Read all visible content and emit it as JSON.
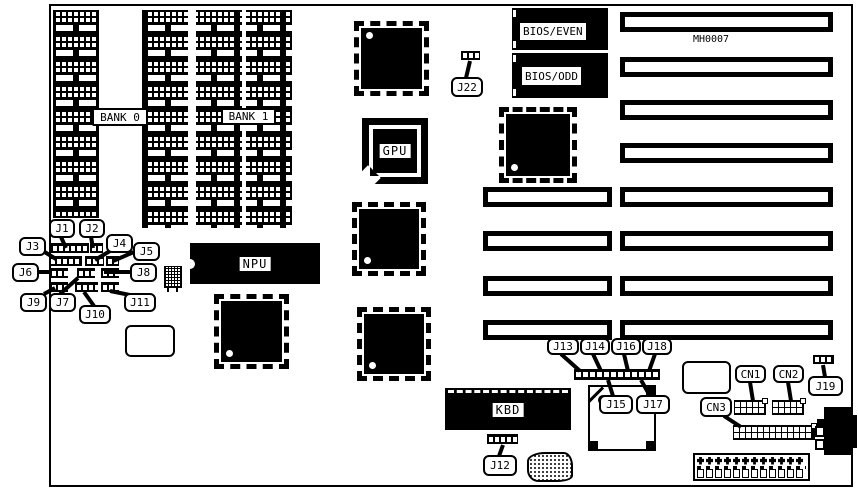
{
  "diagram": {
    "board_id": "MH0007",
    "banks": {
      "bank0": "BANK 0",
      "bank1": "BANK 1"
    },
    "chips": {
      "npu": "NPU",
      "gpu": "GPU",
      "kbd": "KBD",
      "bios_even": "BIOS/EVEN",
      "bios_odd": "BIOS/ODD"
    },
    "jumpers": {
      "j1": "J1",
      "j2": "J2",
      "j3": "J3",
      "j4": "J4",
      "j5": "J5",
      "j6": "J6",
      "j7": "J7",
      "j8": "J8",
      "j9": "J9",
      "j10": "J10",
      "j11": "J11",
      "j12": "J12",
      "j13": "J13",
      "j14": "J14",
      "j15": "J15",
      "j16": "J16",
      "j17": "J17",
      "j18": "J18",
      "j19": "J19",
      "j22": "J22"
    },
    "connectors": {
      "cn1": "CN1",
      "cn2": "CN2",
      "cn3": "CN3"
    },
    "colors": {
      "ink": "#000000",
      "paper": "#ffffff"
    }
  }
}
